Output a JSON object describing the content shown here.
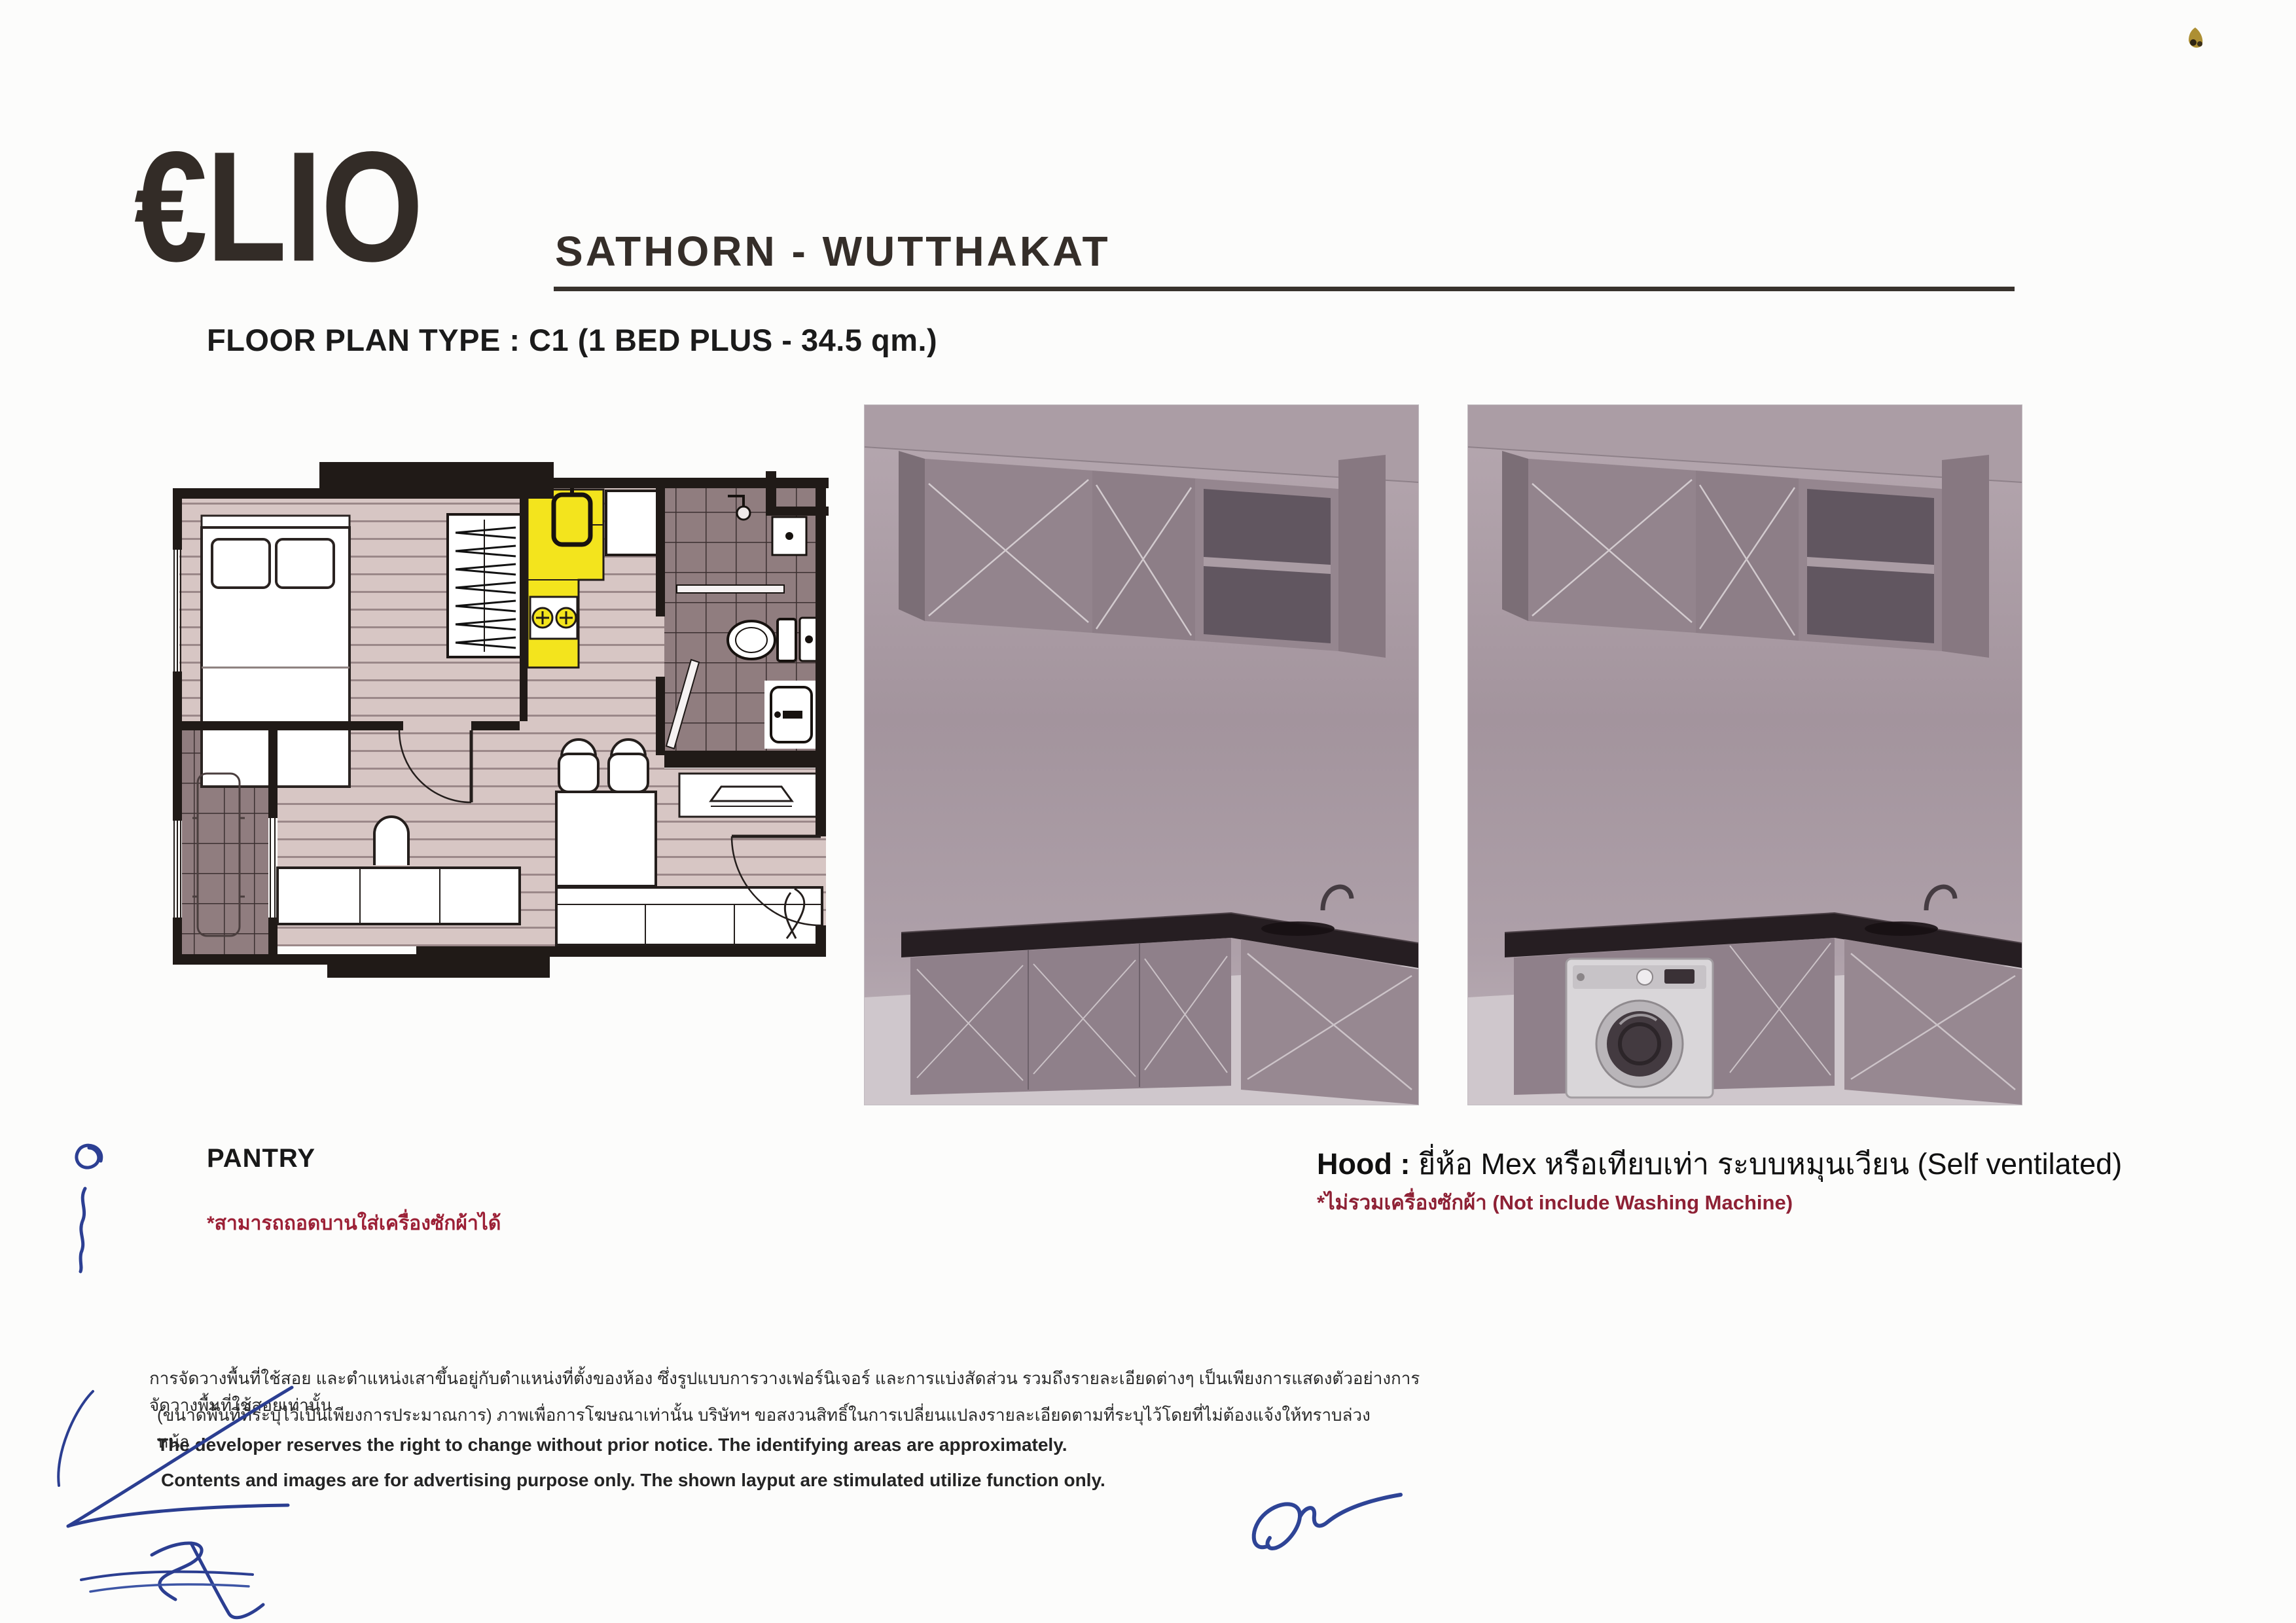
{
  "brand": {
    "logo": "€LIO",
    "project": "SATHORN - WUTTHAKAT"
  },
  "plan": {
    "title": "FLOOR PLAN TYPE : C1 (1 BED PLUS - 34.5 qm.)",
    "pantry_label": "PANTRY",
    "pantry_note_th": "*สามารถถอดบานใส่เครื่องซักผ้าได้"
  },
  "hood": {
    "label": "Hood :",
    "spec": "ยี่ห้อ Mex หรือเทียบเท่า ระบบหมุนเวียน (Self ventilated)",
    "note_th": "*ไม่รวมเครื่องซักผ้า",
    "note_en": "(Not include Washing Machine)"
  },
  "disclaimer": {
    "th1": "การจัดวางพื้นที่ใช้สอย และตำแหน่งเสาขึ้นอยู่กับตำแหน่งที่ตั้งของห้อง ซึ่งรูปแบบการวางเฟอร์นิเจอร์ และการแบ่งสัดส่วน รวมถึงรายละเอียดต่างๆ เป็นเพียงการแสดงตัวอย่างการจัดวางพื้นที่ใช้สอยเท่านั้น",
    "th2": "(ขนาดพื้นที่ที่ระบุไว้เป็นเพียงการประมาณการ) ภาพเพื่อการโฆษณาเท่านั้น บริษัทฯ ขอสงวนสิทธิ์ในการเปลี่ยนแปลงรายละเอียดตามที่ระบุไว้โดยที่ไม่ต้องแจ้งให้ทราบล่วงหน้า",
    "en1": "The developer reserves the right to change without prior notice. The identifying areas are approximately.",
    "en2": "Contents and images are for advertising purpose only. The shown layput are stimulated utilize function only."
  },
  "colors": {
    "paper": "#fcfcfb",
    "ink": "#332c27",
    "note_red": "#9c2036",
    "pen_blue": "#2c3f93",
    "pantry_yellow": "#f3e41d",
    "plan_wall": "#201a17",
    "plan_floor": "#d7c6c4",
    "plan_tile": "#907d7f",
    "render_wall": "#a4959e",
    "render_counter": "#261e22"
  }
}
